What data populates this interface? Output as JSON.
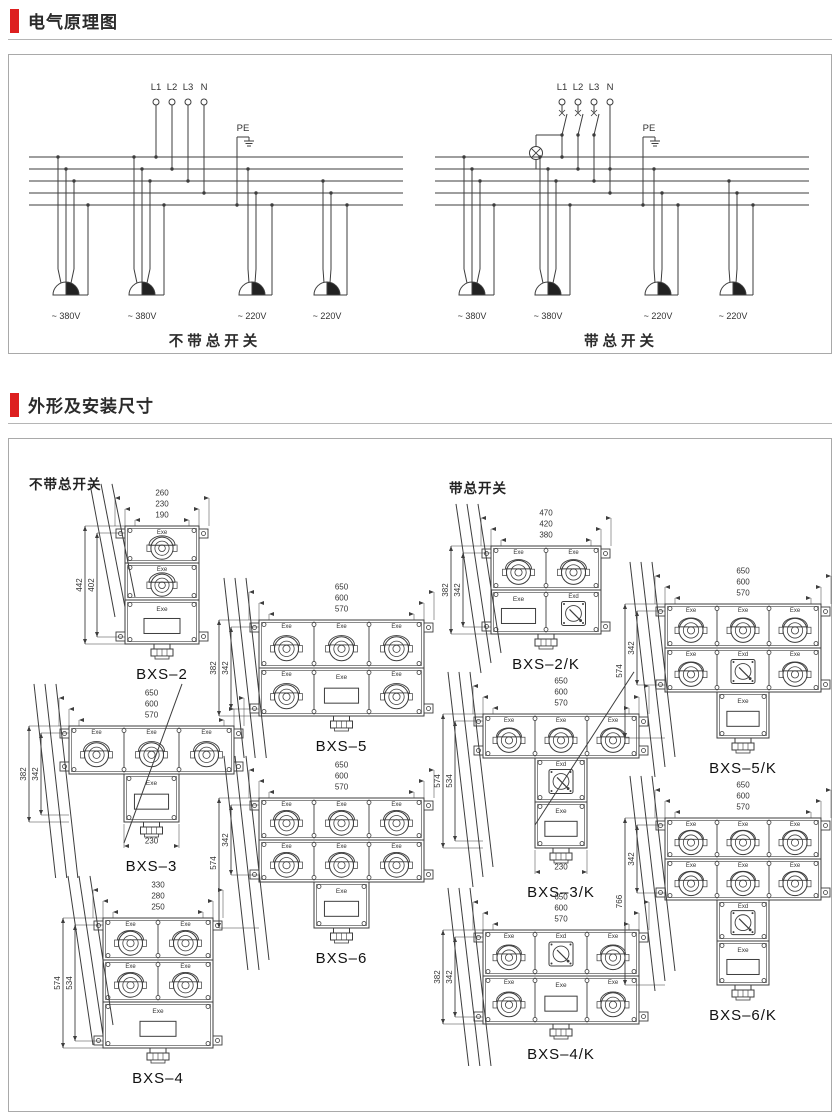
{
  "theme": {
    "accent_red": "#dd1f1f",
    "panel_border": "#a9a9a9",
    "line_color": "#3d3d3d",
    "text_color": "#2b2b2b"
  },
  "sections": [
    {
      "title": "电气原理图"
    },
    {
      "title": "外形及安装尺寸"
    }
  ],
  "circuits": [
    {
      "caption": "不带总开关",
      "has_main_switch": false,
      "phase_labels": [
        "L1",
        "L2",
        "L3",
        "N"
      ],
      "pe_label": "PE",
      "outlets": [
        {
          "voltage": "~ 380V",
          "phases": 3
        },
        {
          "voltage": "~ 380V",
          "phases": 3
        },
        {
          "voltage": "~ 220V",
          "phases": 1
        },
        {
          "voltage": "~ 220V",
          "phases": 1
        }
      ]
    },
    {
      "caption": "带总开关",
      "has_main_switch": true,
      "phase_labels": [
        "L1",
        "L2",
        "L3",
        "N"
      ],
      "pe_label": "PE",
      "outlets": [
        {
          "voltage": "~ 380V",
          "phases": 3
        },
        {
          "voltage": "~ 380V",
          "phases": 3
        },
        {
          "voltage": "~ 220V",
          "phases": 1
        },
        {
          "voltage": "~ 220V",
          "phases": 1
        }
      ]
    }
  ],
  "dimensions": {
    "group_labels": {
      "left": "不带总开关",
      "right": "带总开关"
    },
    "socket_label": "Exe",
    "switch_label": "Exd",
    "panel_label": "Exe",
    "drawings": [
      {
        "name": "BXS–2",
        "top_dims": [
          "260",
          "230",
          "190"
        ],
        "left_dims": [
          "442",
          "402"
        ],
        "left_spans": [
          "full",
          "inset"
        ],
        "bottom_dim": null,
        "rows": [
          [
            "S"
          ],
          [
            "S"
          ],
          [
            "P"
          ]
        ],
        "cw": 74,
        "rh": 37,
        "ph": 44,
        "pos": {
          "left": 66,
          "top": 44
        }
      },
      {
        "name": "BXS–3",
        "top_dims": [
          "650",
          "600",
          "570"
        ],
        "left_dims": [
          "382",
          "342"
        ],
        "left_spans": [
          "full",
          "inset"
        ],
        "bottom_dim": "230",
        "rows": [
          [
            "S",
            "S",
            "S"
          ],
          [
            null,
            "P",
            null
          ]
        ],
        "cw": 55,
        "rh": 48,
        "ph": 48,
        "pos": {
          "left": 10,
          "top": 244
        }
      },
      {
        "name": "BXS–4",
        "top_dims": [
          "330",
          "280",
          "250"
        ],
        "left_dims": [
          "574",
          "534"
        ],
        "left_spans": [
          "full",
          "inset"
        ],
        "bottom_dim": null,
        "rows": [
          [
            "S",
            "S"
          ],
          [
            "S",
            "S"
          ],
          [
            "P*"
          ]
        ],
        "cw": 55,
        "rh": 42,
        "ph": 46,
        "pos": {
          "left": 44,
          "top": 436
        }
      },
      {
        "name": "BXS–5",
        "top_dims": [
          "650",
          "600",
          "570"
        ],
        "left_dims": [
          "382",
          "342"
        ],
        "left_spans": [
          "full",
          "inset"
        ],
        "bottom_dim": null,
        "rows": [
          [
            "S",
            "S",
            "S"
          ],
          [
            "S",
            "P",
            "S"
          ]
        ],
        "cw": 55,
        "rh": 48,
        "ph": 48,
        "pos": {
          "left": 200,
          "top": 138
        }
      },
      {
        "name": "BXS–6",
        "top_dims": [
          "650",
          "600",
          "570"
        ],
        "left_dims": [
          "574",
          "342"
        ],
        "left_spans": [
          "full",
          "block"
        ],
        "bottom_dim": null,
        "rows": [
          [
            "S",
            "S",
            "S"
          ],
          [
            "S",
            "S",
            "S"
          ],
          [
            null,
            "P",
            null
          ]
        ],
        "cw": 55,
        "rh": 42,
        "ph": 46,
        "pos": {
          "left": 200,
          "top": 316
        }
      },
      {
        "name": "BXS–2/K",
        "top_dims": [
          "470",
          "420",
          "380"
        ],
        "left_dims": [
          "382",
          "342"
        ],
        "left_spans": [
          "full",
          "inset"
        ],
        "bottom_dim": null,
        "rows": [
          [
            "S",
            "S"
          ],
          [
            "P",
            "X"
          ]
        ],
        "cw": 55,
        "rh": 44,
        "ph": 44,
        "pos": {
          "left": 432,
          "top": 64
        }
      },
      {
        "name": "BXS–3/K",
        "top_dims": [
          "650",
          "600",
          "570"
        ],
        "left_dims": [
          "574",
          "534"
        ],
        "left_spans": [
          "full",
          "inset"
        ],
        "bottom_dim": "230",
        "rows": [
          [
            "S",
            "S",
            "S"
          ],
          [
            null,
            "X",
            null
          ],
          [
            null,
            "P",
            null
          ]
        ],
        "cw": 52,
        "rh": 44,
        "ph": 46,
        "pos": {
          "left": 424,
          "top": 232
        }
      },
      {
        "name": "BXS–4/K",
        "top_dims": [
          "650",
          "600",
          "570"
        ],
        "left_dims": [
          "382",
          "342"
        ],
        "left_spans": [
          "full",
          "inset"
        ],
        "bottom_dim": null,
        "rows": [
          [
            "S",
            "X",
            "S"
          ],
          [
            "S",
            "P",
            "S"
          ]
        ],
        "cw": 52,
        "rh": 46,
        "ph": 48,
        "pos": {
          "left": 424,
          "top": 448
        }
      },
      {
        "name": "BXS–5/K",
        "top_dims": [
          "650",
          "600",
          "570"
        ],
        "left_dims": [
          "574",
          "342"
        ],
        "left_spans": [
          "full",
          "block"
        ],
        "bottom_dim": null,
        "rows": [
          [
            "S",
            "S",
            "S"
          ],
          [
            "S",
            "X",
            "S"
          ],
          [
            null,
            "P",
            null
          ]
        ],
        "cw": 52,
        "rh": 44,
        "ph": 46,
        "pos": {
          "left": 606,
          "top": 122
        }
      },
      {
        "name": "BXS–6/K",
        "top_dims": [
          "650",
          "600",
          "570"
        ],
        "left_dims": [
          "766",
          "342"
        ],
        "left_spans": [
          "full",
          "block"
        ],
        "bottom_dim": null,
        "rows": [
          [
            "S",
            "S",
            "S"
          ],
          [
            "S",
            "S",
            "S"
          ],
          [
            null,
            "X",
            null
          ],
          [
            null,
            "P",
            null
          ]
        ],
        "cw": 52,
        "rh": 41,
        "ph": 44,
        "pos": {
          "left": 606,
          "top": 336
        }
      }
    ]
  }
}
